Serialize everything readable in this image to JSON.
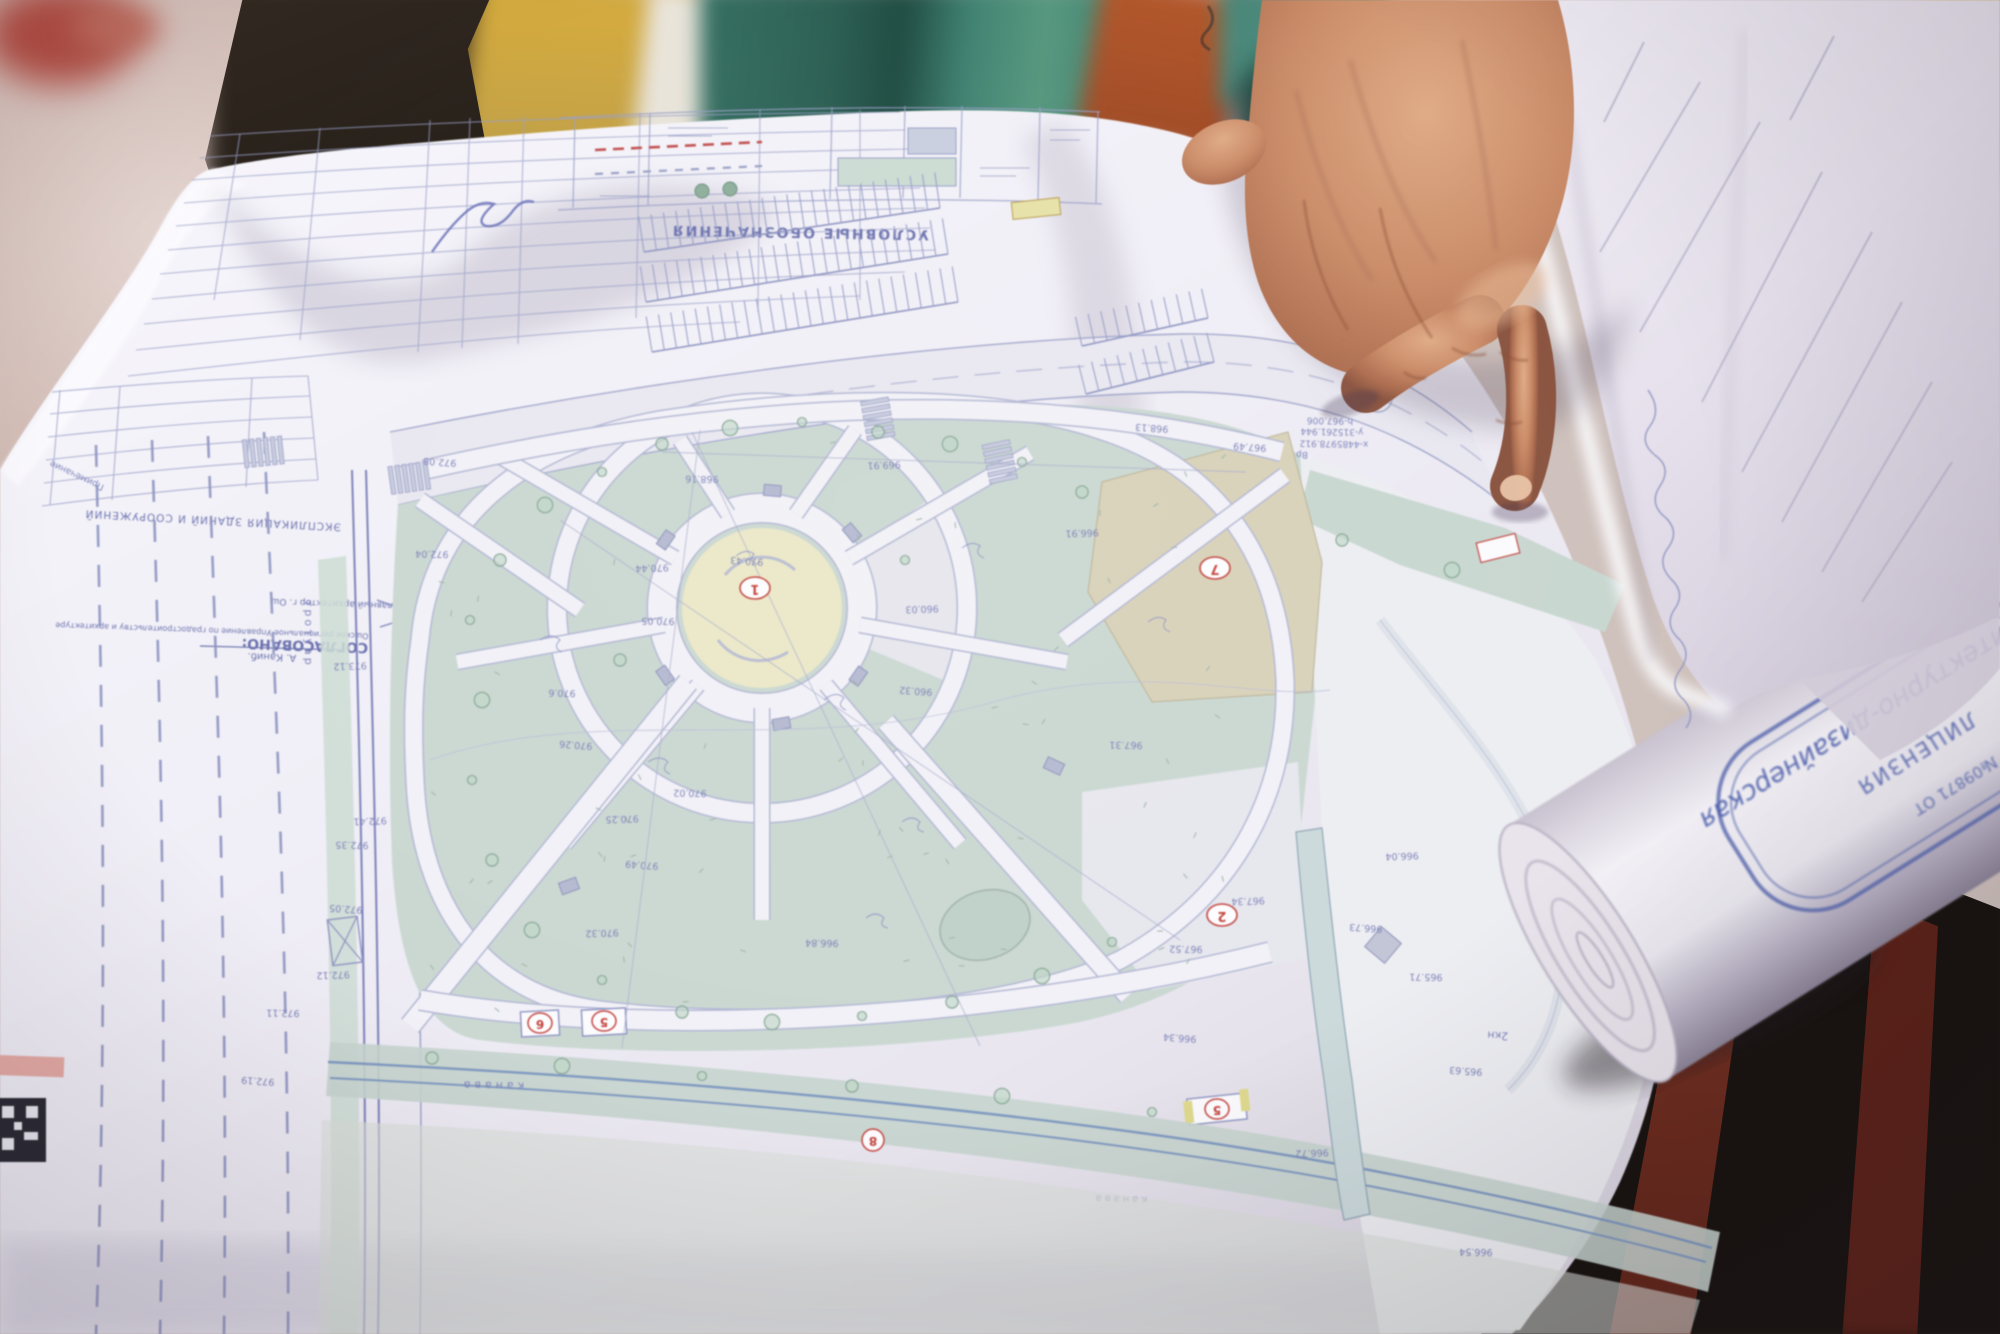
{
  "photo": {
    "description": "Photograph: a man's hand points at an architectural landscape site plan (park with circular alleys) unfolded over an outdoor bench; a second folded sheet and a rolled drawing with a blue licence stamp lie to the right."
  },
  "plan": {
    "legend_title": "УСЛОВНЫЕ ОБОЗНАЧЕНИЯ",
    "explication_title": "ЭКСПЛИКАЦИЯ ЗДАНИЙ И СООРУЖЕНИЙ",
    "note_column_label": "Примечание",
    "approval": {
      "title": "СОГЛАСОВАНО:",
      "org_line": "Ошское региональное Управление по градостроительству и архитектуре",
      "role_line": "Главный архитектор г. Ош",
      "name_line": "А. Каниб."
    },
    "labels": {
      "road": "автодорога",
      "sidewalk": "тротуар",
      "canal": "канава",
      "building": "2кн",
      "bench_mark": "Вр"
    },
    "survey_point": {
      "x": "x-4485978.912",
      "y": "y-315261.944",
      "h": "h-967.006"
    },
    "markers": {
      "center": "1",
      "plaza": "2",
      "pavilion_a": "6",
      "pavilion_b": "5",
      "parcel": "7",
      "path_node": "8",
      "south_pavilion": "5"
    },
    "elevations": [
      "972.41",
      "972.35",
      "972.05",
      "972.12",
      "972.11",
      "972.19",
      "973.12",
      "972.04",
      "972.08",
      "969.91",
      "968.16",
      "970.43",
      "970.44",
      "970.05",
      "970.26",
      "970.25",
      "970.02",
      "970.49",
      "970.32",
      "970.6",
      "960.32",
      "960.03",
      "966.84",
      "967.49",
      "967.34",
      "967.52",
      "966.73",
      "966.04",
      "965.71",
      "965.63",
      "966.72",
      "966.54",
      "968.13",
      "966.91",
      "967.31",
      "966.34"
    ]
  },
  "license_roll": {
    "stamp_line1": "архитектурно-дизайнерская",
    "stamp_line2": "ЛИЦЕНЗИЯ",
    "stamp_line3": "№09871 ОТ"
  },
  "palette": {
    "paper": "#f1eff6",
    "plan_line": "#8a8fc0",
    "green_fill": "#cbd8d2",
    "yellow_center": "#ebe8c8",
    "beige_parcel": "#d9d2ba",
    "marker_red": "#c2453e",
    "skin_mid": "#c88a68",
    "teal_wood": "#3e7f70",
    "brick": "#b4582c",
    "stamp_blue": "#4c5fae"
  }
}
